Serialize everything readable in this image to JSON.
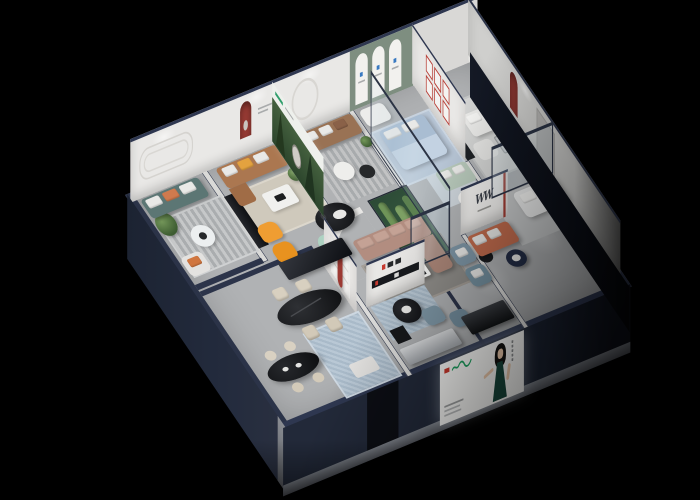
{
  "scene": {
    "type": "3d-isometric-cutaway-render",
    "subject": "furniture showroom floor plan, bird's-eye cutaway view",
    "background_color": "#000000",
    "exterior_wall_color": "#252c3e",
    "floor_color": "#b0b2b4"
  },
  "palette": {
    "interior_wall": "#e9e8e6",
    "sage_accent_wall": "#7e8e80",
    "red_accent_niche": "#963a33",
    "brand_green": "#1d9e5e",
    "brand_red": "#c8382c",
    "sofa_teal": "#5c7674",
    "sofa_caramel": "#ab7750",
    "sofa_brown": "#997254",
    "sofa_mauve": "#b28d80",
    "sofa_coral": "#c06b4d",
    "bed_blue": "#a9bdd2",
    "chair_orange": "#ef9d32",
    "steel_blue": "#7e96a6",
    "mint_bench": "#aed2c2",
    "plant_green": "#4c6c3c",
    "glass_tint": "rgba(185,212,222,0.16)"
  },
  "walls": {
    "brand_mark": "WW",
    "back_wall_sections": [
      {
        "name": "molding-room",
        "decor": "racetrack wall molding"
      },
      {
        "name": "red-arch-room",
        "decor": "red arched niche with sculpture"
      },
      {
        "name": "ring-room",
        "decor": "round mirror ring"
      },
      {
        "name": "sage-arch-room",
        "decor": "three white arch panels with blue marks"
      },
      {
        "name": "gray-room",
        "decor": "plain gray"
      }
    ],
    "east_wall_decor": [
      "red arched niche",
      "door panel"
    ],
    "gallery_wall_frames": 6,
    "forest_poster": {
      "theme": "green forest artwork with white header and green logo"
    },
    "logo_shelf": {
      "accents": "red and black brand glyphs on black wall shelf"
    }
  },
  "billboard": {
    "kind": "illuminated screen on front facade",
    "figure": "woman with black hair in dark green evening dress",
    "logo_mark_color": "#1d9e5e",
    "logo_accent_color": "#c8382c",
    "caption_lines": 3,
    "vertical_text_bars": 1
  },
  "rooms": [
    {
      "id": "A",
      "name": "teal-sofa-lounge",
      "items": [
        "teal 3-seat sofa",
        "striped rug",
        "round white table",
        "tall plant",
        "white armchair with orange pillow",
        "black sideboard"
      ]
    },
    {
      "id": "B",
      "name": "caramel-sofa-lounge",
      "items": [
        "caramel leather sofa",
        "white coffee table",
        "beige rug",
        "floor lamp",
        "two orange lounge chairs",
        "sculpture pedestal"
      ]
    },
    {
      "id": "C",
      "name": "brown-sofa-lounge",
      "items": [
        "brown leather sofa",
        "two round tables",
        "striped rug",
        "plant"
      ]
    },
    {
      "id": "D",
      "name": "blue-bedroom-behind-glass",
      "items": [
        "white armchair",
        "light blue bed with pillows",
        "light blue rug",
        "sage loveseat",
        "round table"
      ]
    },
    {
      "id": "E",
      "name": "white-sofa-suite",
      "items": [
        "white sofa set",
        "glass coffee table",
        "dark media bench with red accents",
        "plant",
        "white chaise",
        "navy round table"
      ]
    },
    {
      "id": "center",
      "name": "mauve-sectional-area",
      "items": [
        "mauve L-sectional",
        "white and black coffee table",
        "curved white partition",
        "mint curved bench",
        "black oval table",
        "cactus vitrine"
      ]
    },
    {
      "id": "dining",
      "name": "dining-and-bar",
      "items": [
        "black oval dining table",
        "four cream chairs",
        "black oval bar table",
        "cream stools",
        "black glossy cabinet",
        "blue patterned rug",
        "white display niche with red curved sculpture"
      ]
    },
    {
      "id": "front",
      "name": "front-lounge",
      "items": [
        "two steel-blue armchairs",
        "black round tables",
        "two blue-gray poufs",
        "silver media bench",
        "black bench",
        "white bench"
      ]
    }
  ]
}
